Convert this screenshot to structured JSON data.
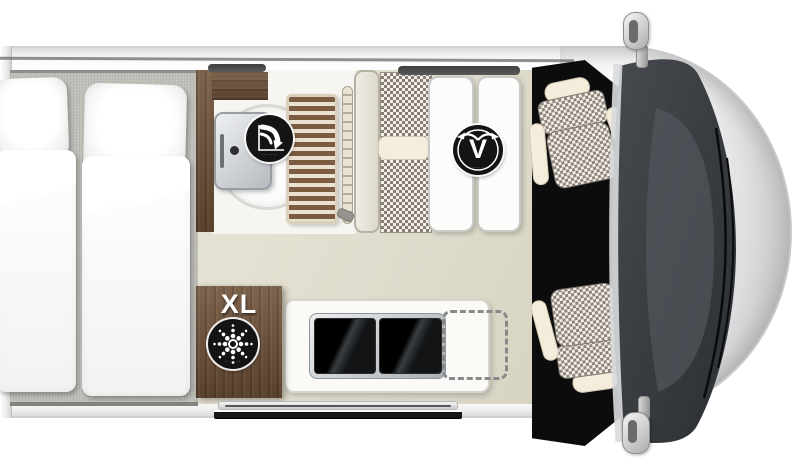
{
  "page": {
    "description": "Top-down floor plan of a campervan with twin rear beds, bathroom, dinette, kitchen and swivel cab seats"
  },
  "badges": {
    "swivel_bath": {
      "caption": "·······"
    },
    "vario_seating": {
      "letter": "V",
      "caption": "·······"
    },
    "fridge": {
      "label": "XL",
      "caption": "·······"
    }
  },
  "colors": {
    "floor": "#e4e0d2",
    "bed_platform": "#c0bfb9",
    "wood": "#6f5138",
    "upholstery_check": "#887e75",
    "seat_trim": "#f4eddc",
    "windshield_glass": "#3c4045",
    "badge_black": "#141414",
    "van_body": "#fdfdfd"
  }
}
